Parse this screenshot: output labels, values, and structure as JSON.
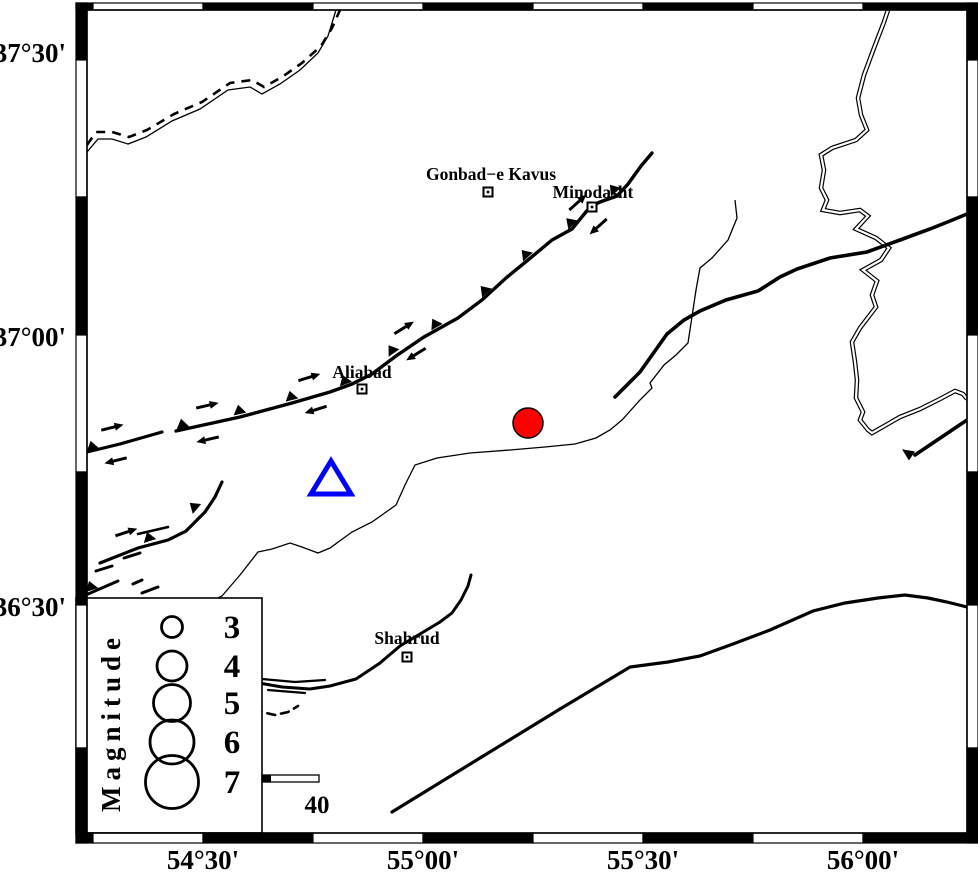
{
  "colors": {
    "ink": "#000000",
    "epicenter_red": "#ff0000",
    "station_blue": "#0000ff",
    "paper": "#ffffff"
  },
  "frame": {
    "x_ticks": [
      {
        "label": "54°30'",
        "x": 203
      },
      {
        "label": "55°00'",
        "x": 423
      },
      {
        "label": "55°30'",
        "x": 643
      },
      {
        "label": "56°00'",
        "x": 863
      }
    ],
    "y_ticks": [
      {
        "label": "37°30'",
        "y": 62
      },
      {
        "label": "37°00'",
        "y": 346
      },
      {
        "label": "36°30'",
        "y": 616
      }
    ],
    "x_bounds": [
      76,
      93,
      203,
      313,
      423,
      533,
      643,
      753,
      863,
      978
    ],
    "y_bounds": [
      3,
      60,
      197,
      335,
      472,
      605,
      748,
      843
    ]
  },
  "cities": [
    {
      "name": "Gonbad−e Kavus",
      "marker_x": 488,
      "marker_y": 192,
      "label_x": 491,
      "label_y": 180
    },
    {
      "name": "Minodasht",
      "marker_x": 592,
      "marker_y": 207,
      "label_x": 593,
      "label_y": 198
    },
    {
      "name": "Aliabad",
      "marker_x": 362,
      "marker_y": 389,
      "label_x": 362,
      "label_y": 378
    },
    {
      "name": "Shahrud",
      "marker_x": 407,
      "marker_y": 657,
      "label_x": 407,
      "label_y": 644
    }
  ],
  "symbols": {
    "epicenter": {
      "x": 528,
      "y": 423,
      "r": 15
    },
    "station": {
      "points": "331,461 311,494 351,494"
    }
  },
  "legend": {
    "title": "Magnitude",
    "circle_x": 172,
    "value_x": 232,
    "entries": [
      {
        "value": "3",
        "cy": 627,
        "r": 10.5
      },
      {
        "value": "4",
        "cy": 666,
        "r": 15
      },
      {
        "value": "5",
        "cy": 703,
        "r": 18.5
      },
      {
        "value": "6",
        "cy": 742,
        "r": 22
      },
      {
        "value": "7",
        "cy": 782,
        "r": 26.5
      }
    ]
  },
  "scalebar": {
    "label": "40"
  },
  "features": {
    "rivers": [
      {
        "id": "river-nw",
        "d": "M87,152 L98,139 L112,139 L128,144 L146,137 L172,121 L200,109 L228,90 L250,87 L262,94 L280,84 L300,70 L318,53 L328,36 L336,10",
        "w": 1.3
      },
      {
        "id": "border-nw-dashed",
        "d": "M87,145 L96,132 L112,132 L129,137 L147,130 L174,114 L202,102 L230,83 L252,80 L264,87 L282,77 L302,63 L321,46 L332,28 L340,10",
        "w": 2.6,
        "dash": "9,7"
      },
      {
        "id": "river-central",
        "d": "M735,200 L737,218 L728,240 L712,258 L700,268 L696,290 L693,310 L688,343 L676,355 L664,365 L650,383 L652,388 L640,400 L622,420 L610,430 L596,438 L575,444 L545,447 L510,450 L470,453 L437,458 L415,465 L405,485 L396,505 L372,522 L352,532 L330,548 L318,553 L302,547 L290,543 L272,549 L258,552 L240,575 L222,596 L218,598",
        "w": 1.3
      },
      {
        "id": "river-east-double",
        "d": "M888,10 L884,22 L874,48 L864,75 L858,98 L861,115 L867,130 L856,140 L832,148 L821,155 L824,170 L821,188 L827,200 L823,210 L840,213 L860,210 L868,216 L856,229 L876,238 L889,248 L881,260 L863,270 L877,281 L872,295 L876,307 L860,328 L852,342 L855,362 L857,380 L856,398 L863,412 L860,420 L868,430 L872,433 L900,417 L920,409 L940,399 L955,391 L963,394 L967,399",
        "w": 1.2,
        "double": true
      }
    ],
    "faults": [
      {
        "id": "fault-main-west",
        "d": "M87,452 L120,444 L162,432",
        "w": 3.2
      },
      {
        "id": "fault-main",
        "d": "M176,431 L240,417 L292,403 L330,392 L352,384 L372,374 L396,356 L424,337 L458,318 L482,300 L506,278 L528,260 L552,240 L572,229 L590,207 L600,202 L617,196 L628,184 L641,166 L652,153",
        "w": 3.4
      },
      {
        "id": "fault-southwest",
        "d": "M100,563 L138,548 L168,540 L186,531 L205,512 L215,497 L222,482",
        "w": 3.2
      },
      {
        "id": "fault-southwest-stub",
        "d": "M138,534 L168,527",
        "w": 2.6
      },
      {
        "id": "fault-ne-diagonal",
        "d": "M615,397 L640,372 L667,334 L684,320 L700,311 L726,300 L758,291 L780,277 L797,269 L830,258 L867,252 L900,240 L930,229 L950,221 L967,214",
        "w": 3.6
      },
      {
        "id": "fault-south-long",
        "d": "M392,812 L480,758 L560,709 L630,667 L668,662 L700,656 L733,644 L770,630 L813,611 L845,603 L878,598 L905,595 L928,598 L947,602 L967,607",
        "w": 3.2
      },
      {
        "id": "fault-shahrud",
        "d": "M259,683 L282,687 L310,689 L330,686 L356,679 L380,663 L400,646 L420,634 L440,622 L452,613 L461,600 L468,586 L471,575",
        "w": 3
      },
      {
        "id": "fault-shahrud-braid1",
        "d": "M262,679 L295,682 L325,680",
        "w": 2.2
      },
      {
        "id": "fault-shahrud-braid2",
        "d": "M268,690 L305,693",
        "w": 2.2
      },
      {
        "id": "fault-dashed-arc",
        "d": "M256,706 L262,712 L275,715 L288,712 L298,706",
        "w": 2.6,
        "dash": "8,6"
      },
      {
        "id": "fault-right-short",
        "d": "M967,420 L915,455",
        "w": 3.6
      },
      {
        "id": "frag-sw-1",
        "d": "M88,594 L118,581",
        "w": 3
      },
      {
        "id": "frag-sw-2",
        "d": "M96,571 L112,566",
        "w": 3
      },
      {
        "id": "frag-sw-3",
        "d": "M124,558 L140,553",
        "w": 3
      },
      {
        "id": "frag-sw-4",
        "d": "M142,593 L158,587",
        "w": 3
      },
      {
        "id": "frag-sw-5",
        "d": "M133,584 L142,580",
        "w": 3
      }
    ],
    "teeth": [
      {
        "x": 93,
        "y": 450,
        "a": -15
      },
      {
        "x": 183,
        "y": 428,
        "a": -12
      },
      {
        "x": 240,
        "y": 414,
        "a": -12
      },
      {
        "x": 292,
        "y": 400,
        "a": -15
      },
      {
        "x": 346,
        "y": 384,
        "a": -20
      },
      {
        "x": 394,
        "y": 353,
        "a": -35
      },
      {
        "x": 437,
        "y": 327,
        "a": -30
      },
      {
        "x": 487,
        "y": 293,
        "a": -42
      },
      {
        "x": 528,
        "y": 257,
        "a": -42
      },
      {
        "x": 573,
        "y": 225,
        "a": -45
      },
      {
        "x": 616,
        "y": 192,
        "a": -40
      },
      {
        "x": 150,
        "y": 541,
        "a": -18
      },
      {
        "x": 197,
        "y": 509,
        "a": -50
      },
      {
        "x": 92,
        "y": 590,
        "a": -18
      }
    ],
    "arrows": [
      {
        "x": 110,
        "y": 428,
        "a": -14
      },
      {
        "x": 205,
        "y": 406,
        "a": -13
      },
      {
        "x": 307,
        "y": 378,
        "a": -17
      },
      {
        "x": 402,
        "y": 329,
        "a": -32
      },
      {
        "x": 576,
        "y": 204,
        "a": -42
      },
      {
        "x": 118,
        "y": 460,
        "a": 166
      },
      {
        "x": 210,
        "y": 439,
        "a": 167
      },
      {
        "x": 318,
        "y": 409,
        "a": 163
      },
      {
        "x": 418,
        "y": 353,
        "a": 148
      },
      {
        "x": 600,
        "y": 225,
        "a": 138
      },
      {
        "x": 124,
        "y": 533,
        "a": -18
      }
    ],
    "arrowheads": [
      {
        "x": 912,
        "y": 456,
        "a": 214
      }
    ]
  }
}
